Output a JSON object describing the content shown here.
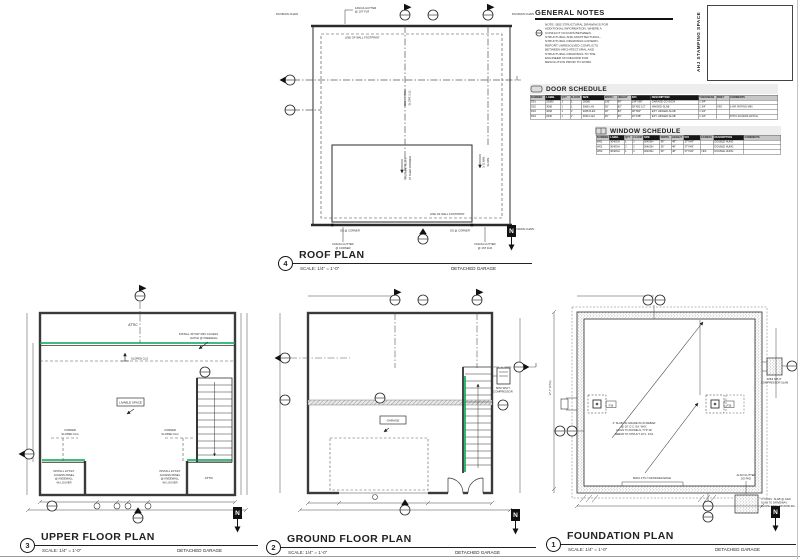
{
  "accent_green": "#00a651",
  "titlebar": {
    "scale": "SCALE: 1/4\" = 1'-0\"",
    "building": "DETACHED GARAGE",
    "north": "N"
  },
  "general_notes": {
    "title": "GENERAL NOTES",
    "note": "NOTE: SEE STRUCTURAL DRAWINGS FOR ADDITIONAL INFORMATION. WHERE A CONFLICT OCCURS BETWEEN STRUCTURAL AND ARCHITECTURAL - STRUCTURAL DRAWINGS GOVERN. REPORT UNRESOLVED CONFLICTS BETWEEN ARCHITECTURAL AND STRUCTURAL DRAWINGS TO THE ENGINEER ON RECORD FOR RESOLUTION PRIOR TO WORK."
  },
  "stamp_box": {
    "label": "AHJ STAMPING SPACE"
  },
  "door_schedule": {
    "title": "DOOR SCHEDULE",
    "headers": [
      "NUMBER",
      "LABEL",
      "QTY",
      "FLOOR",
      "SIZE",
      "WIDTH",
      "HEIGHT",
      "R/O",
      "DESCRIPTION",
      "THICKNESS",
      "FIRE?",
      "COMMENTS"
    ],
    "dark_headers": [
      1,
      4,
      7,
      8
    ],
    "col_widths": [
      6,
      6,
      3.5,
      4.5,
      9,
      5,
      5.5,
      8,
      20,
      7,
      5,
      20.5
    ],
    "rows": [
      [
        "D01",
        "16080",
        "1",
        "1",
        "16080",
        "192\"",
        "96\"",
        "194\"X99\"",
        "GARAGE-CO-SG24",
        "1 3/4\"",
        "",
        ""
      ],
      [
        "D02",
        "3068",
        "1",
        "1",
        "3068 L-IN",
        "36\"",
        "80\"",
        "38\"X82 1/2\"",
        "HINGED-SLAB",
        "1 3/4\"",
        "YES",
        "1-HR. RATING MIN."
      ],
      [
        "D03",
        "3068",
        "1",
        "2",
        "3068 R-EX",
        "36\"",
        "80\"",
        "38\"X82\"",
        "EXT. HINGED-SLAB",
        "1 3/4\"",
        "",
        ""
      ],
      [
        "D04",
        "2630",
        "1",
        "2",
        "2630 L-EX",
        "30\"",
        "36\"",
        "32\"X38\"",
        "EXT. HINGED-SLAB",
        "1 3/4\"",
        "",
        "ATTIC ACCESS HATCH"
      ]
    ]
  },
  "window_schedule": {
    "title": "WINDOW SCHEDULE",
    "headers": [
      "NUMBER",
      "LABEL",
      "QTY",
      "FLOOR",
      "SIZE",
      "WIDTH",
      "HEIGHT",
      "R/O",
      "EGRESS",
      "DESCRIPTION",
      "COMMENTS"
    ],
    "dark_headers": [
      1,
      4,
      7,
      9
    ],
    "col_widths": [
      7,
      8,
      4,
      5.5,
      9,
      6,
      6.5,
      9,
      7,
      17,
      21
    ],
    "rows": [
      [
        "W01",
        "3040SH",
        "1",
        "1",
        "3040SH",
        "36\"",
        "48\"",
        "37\"X49\"",
        "",
        "DOUBLE HUNG",
        ""
      ],
      [
        "W02",
        "3040SH",
        "2",
        "2",
        "3040SH",
        "36\"",
        "48\"",
        "37\"X49\"",
        "",
        "DOUBLE HUNG",
        ""
      ],
      [
        "W03",
        "3040SH",
        "1",
        "2",
        "3040SH",
        "36\"",
        "48\"",
        "37\"X49\"",
        "YES",
        "DOUBLE HUNG",
        ""
      ]
    ]
  },
  "plans": {
    "roof": {
      "number": "4",
      "title": "ROOF PLAN",
      "labels": {
        "ds_chain": "DS DRAIN CHAIN",
        "fascia_top": [
          "FASCIA GUTTER",
          "@ 1ST FLR"
        ],
        "fascia_corner": [
          "FASCIA GUTTER",
          "@ CORNER"
        ],
        "fascia_bottom": [
          "FASCIA GUTTER",
          "@ 1ST FLR"
        ],
        "footprint": "LINE OF WALL FOOTPRINT",
        "ds_corner": "DS @ CORNER",
        "ridge_note": [
          "ROOF PITCH",
          "SLOPE 3:12"
        ],
        "slope_center": [
          "3:12 MIN. SLOPE",
          "AT SHED DORMER"
        ],
        "slope_right": [
          "3:12 MIN.",
          "SLOPE"
        ]
      }
    },
    "upper": {
      "number": "3",
      "title": "UPPER FLOOR PLAN",
      "labels": {
        "attic": "ATTIC",
        "hatch_note": [
          "INSTALL 30\"X30\" MIN. ACCESS",
          "HATCH @ KNEEWALL"
        ],
        "sloped": "SLOPED CLG",
        "livable": "LIVABLE SPACE",
        "corner_sloped": [
          "CORNER",
          "SLOPED CLG"
        ],
        "panel_note": [
          "INSTALL 24\"X24\"",
          "ACCESS PANEL",
          "@ KNEEWALL",
          "W/ LOUVER"
        ]
      }
    },
    "ground": {
      "number": "2",
      "title": "GROUND FLOOR PLAN",
      "labels": {
        "garage": "GARAGE",
        "mini_split": [
          "MINI SPLIT",
          "COMPRESSOR"
        ]
      }
    },
    "foundation": {
      "number": "1",
      "title": "FOUNDATION PLAN",
      "labels": {
        "slab_note": [
          "4\" SLAB ON GRADE W/ #4 REBAR",
          "@ 16\" O.C. EA. WAY,",
          "ALIGN TO DOWELS, TYP. W/",
          "REBAR TO STRUCT. DTL. 1/S1"
        ],
        "ftg_edge": "BLDG FTG THICKENED EDGE",
        "gutter_pad": [
          "ALSO GUTTER",
          "DS PAD"
        ],
        "pad_note": [
          "4\" CONC. SLAB @ GAR.",
          "SLAB TO DRIVEWAY,",
          "SLOPE AWAY FROM BLDG."
        ],
        "mini_split": [
          "MINI SPLIT",
          "COMPRESSOR SLAB"
        ],
        "pier_tag": "F36",
        "dim_left": "17'-7\" (FTG)"
      }
    }
  }
}
